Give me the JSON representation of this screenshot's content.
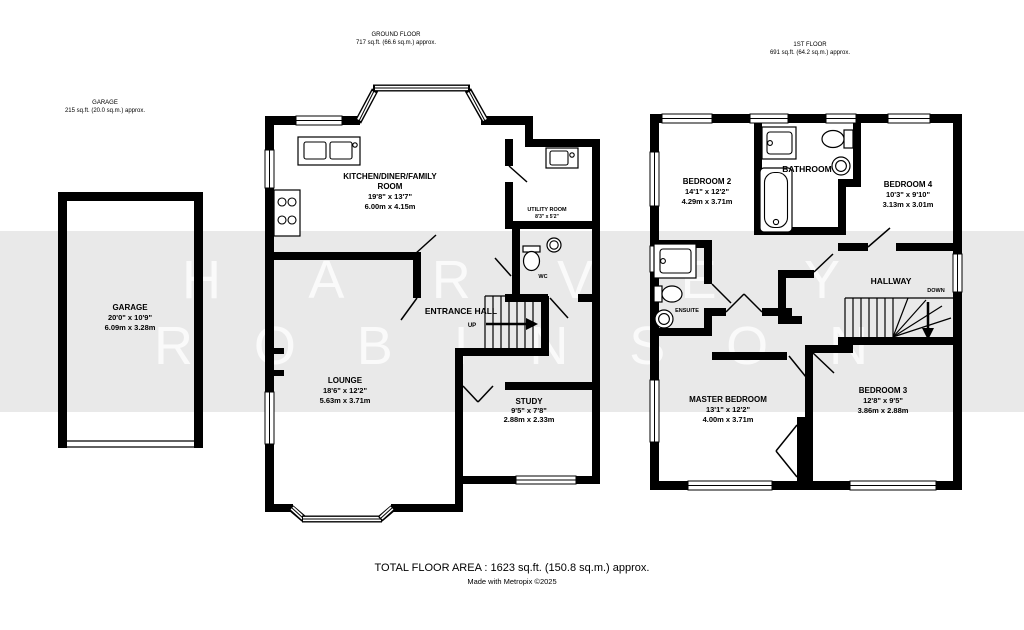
{
  "headers": {
    "garage": {
      "title": "GARAGE",
      "area": "215 sq.ft. (20.0 sq.m.) approx."
    },
    "ground": {
      "title": "GROUND FLOOR",
      "area": "717 sq.ft. (66.6 sq.m.) approx."
    },
    "first": {
      "title": "1ST FLOOR",
      "area": "691 sq.ft. (64.2 sq.m.) approx."
    }
  },
  "rooms": {
    "garage": {
      "name": "GARAGE",
      "imperial": "20'0\" x 10'9\"",
      "metric": "6.09m x 3.28m"
    },
    "kitchen": {
      "name": "KITCHEN/DINER/FAMILY",
      "name2": "ROOM",
      "imperial": "19'8\" x 13'7\"",
      "metric": "6.00m x 4.15m"
    },
    "utility": {
      "name": "UTILITY ROOM",
      "imperial": "8'3\" x 5'2\"",
      "metric": "2.51m x 1.57m"
    },
    "lounge": {
      "name": "LOUNGE",
      "imperial": "18'6\" x 12'2\"",
      "metric": "5.63m x 3.71m"
    },
    "study": {
      "name": "STUDY",
      "imperial": "9'5\" x 7'8\"",
      "metric": "2.88m x 2.33m"
    },
    "bedroom2": {
      "name": "BEDROOM 2",
      "imperial": "14'1\" x 12'2\"",
      "metric": "4.29m x 3.71m"
    },
    "bedroom4": {
      "name": "BEDROOM 4",
      "imperial": "10'3\" x 9'10\"",
      "metric": "3.13m x 3.01m"
    },
    "bedroom3": {
      "name": "BEDROOM 3",
      "imperial": "12'8\" x 9'5\"",
      "metric": "3.86m x 2.88m"
    },
    "master": {
      "name": "MASTER BEDROOM",
      "imperial": "13'1\" x 12'2\"",
      "metric": "4.00m x 3.71m"
    }
  },
  "labels": {
    "entrance_hall": "ENTRANCE HALL",
    "wc": "WC",
    "up": "UP",
    "down": "DOWN",
    "hallway": "HALLWAY",
    "bathroom": "BATHROOM",
    "ensuite": "ENSUITE"
  },
  "watermark": {
    "line1": "HARVEY",
    "line2": "ROBINSON"
  },
  "footer": {
    "total": "TOTAL FLOOR AREA : 1623 sq.ft. (150.8 sq.m.) approx.",
    "credit": "Made with Metropix ©2025"
  },
  "colors": {
    "wall": "#000000",
    "band": "#e9e9e9",
    "watermark": "#ffffff",
    "background": "#ffffff"
  }
}
